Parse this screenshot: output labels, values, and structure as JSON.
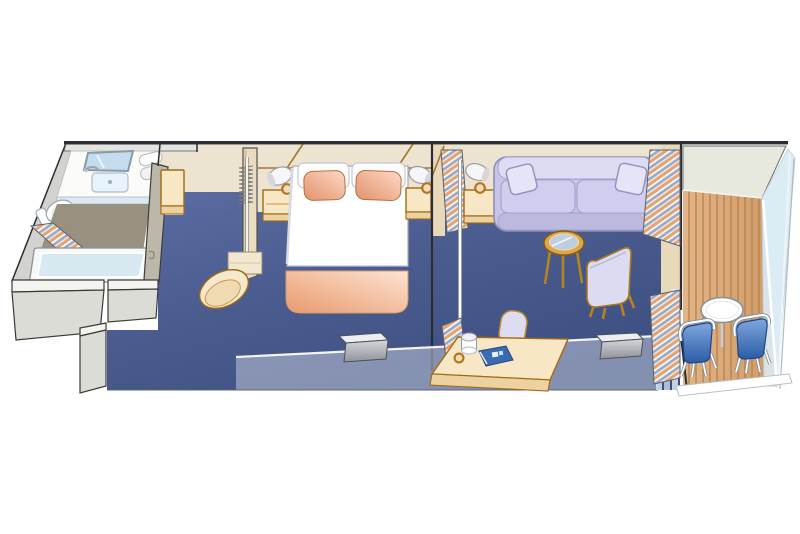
{
  "title": "Stateroom Floor Plan",
  "description": "Isometric cutaway illustration of a cruise ship mini-suite stateroom: bathroom with tub, entry corridor with open closet, bedroom with queen bed, sitting area with sofa and desk, and a private teak balcony with table and chairs",
  "rooms": {
    "bathroom": {
      "label": "Bathroom",
      "items": [
        "mirror",
        "vanity-sink",
        "towels",
        "toilet",
        "bathtub",
        "shower-curtain"
      ]
    },
    "corridor": {
      "label": "Entry corridor",
      "items": [
        "closet-rail",
        "clothes-hangers",
        "bench"
      ]
    },
    "bedroom": {
      "label": "Bedroom",
      "items": [
        "queen-bed",
        "two-pillows",
        "nightstand-left",
        "nightstand-right",
        "reading-lamps",
        "wall-tv"
      ]
    },
    "sitting": {
      "label": "Sitting area",
      "items": [
        "sofa",
        "throw-pillows",
        "lamp-table",
        "round-coffee-table",
        "armchair",
        "desk",
        "desk-chair",
        "coffee-cup",
        "guide-book",
        "wall-tv"
      ]
    },
    "balcony": {
      "label": "Balcony",
      "items": [
        "teak-deck",
        "round-table",
        "two-chairs",
        "glass-railing",
        "privacy-curtains"
      ]
    }
  },
  "colors": {
    "outline": "#2c2c34",
    "floorLight": "#5b6da3",
    "floorMid": "#4a5b8e",
    "floorDark": "#3d4e80",
    "wallBeige": "#ece4d0",
    "wallStrip": "#e8d9ba",
    "patternBrown": "#a8752c",
    "furnitureTan": "#f8e7c4",
    "furnitureTanDark": "#ecd2a0",
    "furnitureOutline": "#a06a14",
    "lampAmber": "#b5761f",
    "sofaBase": "#c6c4e8",
    "sofaLight": "#dddcf2",
    "sofaCushion": "#d0ceee",
    "sofaOutline": "#8c8ab8",
    "pillowLight": "#fcd9c6",
    "pillowDark": "#e4926c",
    "blanketLight": "#fde4d2",
    "blanketDark": "#e89a6e",
    "bathWall": "#d2d2ce",
    "bathFloor": "#99917f",
    "mirrorBlue": "#c3dcee",
    "sinkBlue": "#e8f2fa",
    "tubInner": "#d8e8f0",
    "stripeCream": "#f3e6d2",
    "stripePeach": "#e2a377",
    "stripeBlue": "#93a8cf",
    "deckLight": "#e2b487",
    "deckDark": "#cf9a66",
    "plankLine": "#b5814e",
    "overhang": "#e7e9de",
    "glassBlue": "#d9ebf5",
    "chairBlueLight": "#7fa6dd",
    "chairBlueDark": "#2c5ca6",
    "tvLight": "#d4d7db",
    "tvDark": "#8f939a",
    "bookBlue": "#3a6ab2",
    "bandGlass": "rgba(203,210,223,0.5)",
    "white": "#ffffff"
  }
}
